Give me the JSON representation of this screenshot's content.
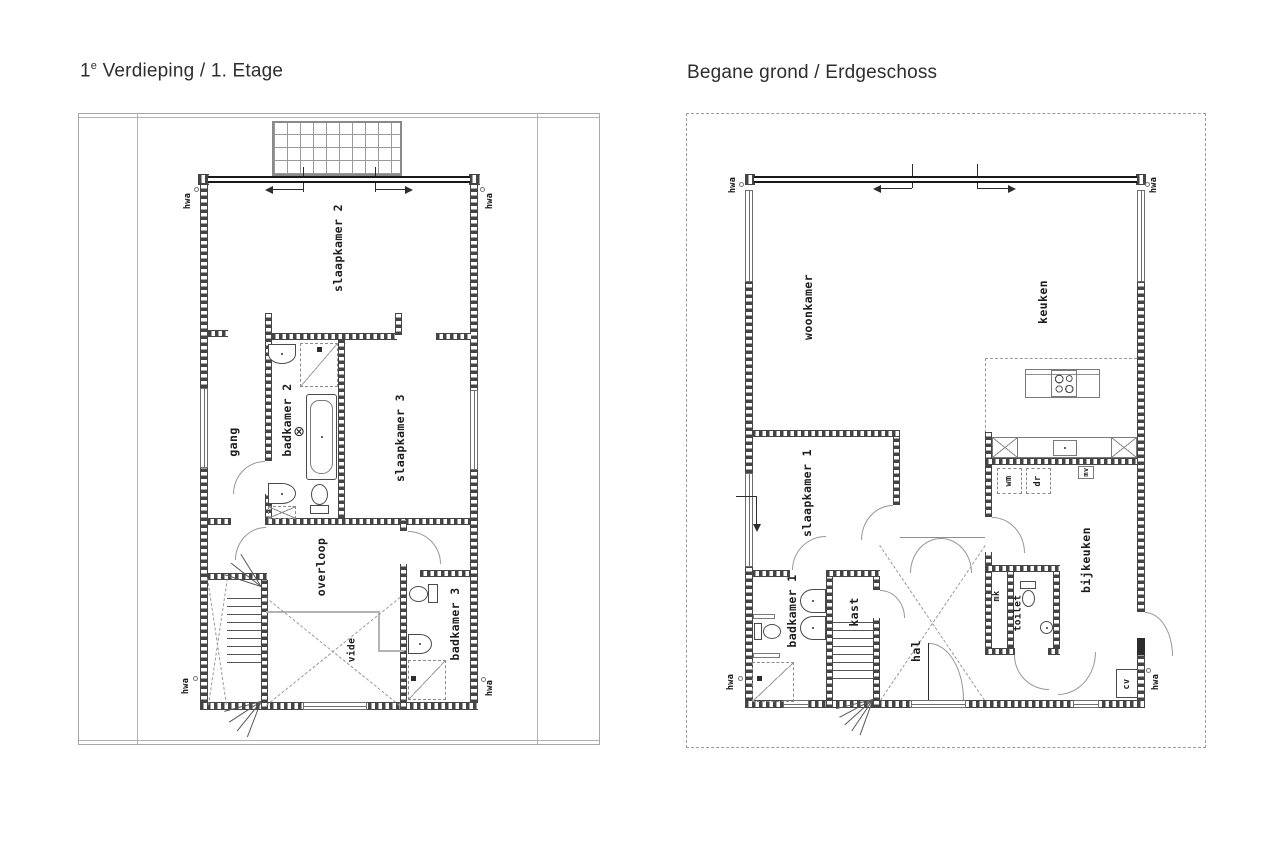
{
  "left_plan": {
    "title": {
      "prefix": "1",
      "sup": "e",
      "rest": " Verdieping / 1. Etage"
    },
    "labels": {
      "slaapkamer2": "slaapkamer 2",
      "gang": "gang",
      "badkamer2": "badkamer 2",
      "slaapkamer3": "slaapkamer 3",
      "overloop": "overloop",
      "vide": "vide",
      "badkamer3": "badkamer 3"
    },
    "symbols": {
      "light": "⊗"
    },
    "hwa": "hwa"
  },
  "right_plan": {
    "title": "Begane grond / Erdgeschoss",
    "labels": {
      "woonkamer": "woonkamer",
      "keuken": "keuken",
      "slaapkamer1": "slaapkamer 1",
      "badkamer1": "badkamer 1",
      "kast": "kast",
      "hal": "hal",
      "mk": "mk",
      "toilet": "toilet",
      "bijkeuken": "bijkeuken",
      "wm": "wm",
      "dr": "dr",
      "mv": "mv",
      "cv": "cv"
    },
    "hwa": "hwa"
  },
  "colors": {
    "wall": "#454545",
    "glass": "#191919",
    "arc": "#979797",
    "frame": "#a8a8a8",
    "text": "#1d1d1d"
  }
}
